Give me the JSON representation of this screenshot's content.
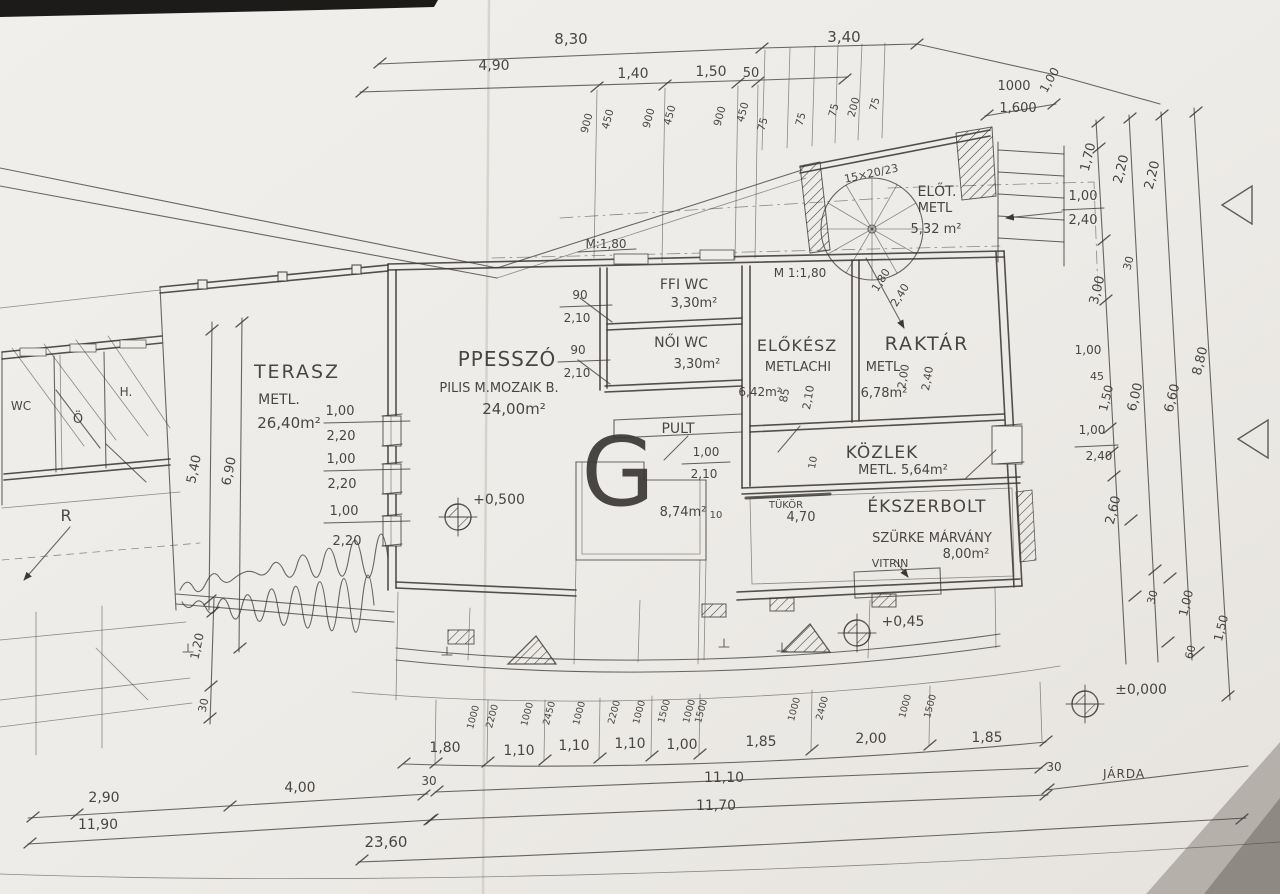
{
  "meta": {
    "kind": "scanned hand-drawn architectural floor plan"
  },
  "watermark": "G",
  "rooms": {
    "terasz": {
      "name": "TERASZ",
      "mat": "METL.",
      "area": "26,40m²"
    },
    "presszo": {
      "name": "PPESSZÓ",
      "mat": "PILIS M.MOZAIK B.",
      "area": "24,00m²"
    },
    "ffi_wc": {
      "name": "FFI WC",
      "area": "3,30m²"
    },
    "noi_wc": {
      "name": "NŐI WC",
      "area": "3,30m²"
    },
    "elokesz": {
      "name": "ELŐKÉSZ",
      "mat": "METLACHI",
      "area": "6,42m²"
    },
    "raktar": {
      "name": "RAKTÁR",
      "mat": "METL",
      "area": "6,78m²"
    },
    "elot": {
      "name": "ELŐT.",
      "mat": "METL",
      "area": "5,32 m²"
    },
    "kozlek": {
      "name": "KÖZLEK",
      "mat": "METL. 5,64m²"
    },
    "ekszerbolt": {
      "name": "ÉKSZERBOLT",
      "mat": "SZÜRKE MÁRVÁNY",
      "area": "8,00m²"
    },
    "pult": "PULT",
    "eloter_area": "8,74m²",
    "tukor": "TÜKÖR",
    "vitrin": "VITRIN",
    "wc": "WC",
    "o": "Ö",
    "h": "H.",
    "r": "R"
  },
  "notes": {
    "stair": "15×20/23",
    "scale1": "M:1,80",
    "scale2": "M 1:1,80",
    "jarda": "JÁRDA"
  },
  "levels": {
    "terasz": "+0,500",
    "entrance": "+0,45",
    "street": "±0,000"
  },
  "dims": {
    "top1": [
      "8,30",
      "3,40"
    ],
    "top2": [
      "4,90",
      "1,40",
      "1,50",
      "50"
    ],
    "topv": [
      "900",
      "450",
      "900",
      "450",
      "900",
      "450",
      "75",
      "75",
      "75",
      "200",
      "75"
    ],
    "topr": [
      "1000",
      "1,600",
      "1,00"
    ],
    "right": [
      "1,70",
      "2,20",
      "2,20",
      "1,00",
      "2,40",
      "30",
      "3,00",
      "1,00",
      "45",
      "1,50",
      "6,00",
      "6,60",
      "8,80",
      "1,00",
      "2,40",
      "2,60",
      "30",
      "1,00",
      "1,50",
      "60"
    ],
    "left": [
      "5,40",
      "6,90",
      "1,20",
      "30"
    ],
    "west": [
      "1,00",
      "2,20",
      "1,00",
      "2,20",
      "1,00",
      "2,20"
    ],
    "doors": [
      "90",
      "2,10",
      "90",
      "2,10",
      "85",
      "2,10",
      "1,00",
      "2,10",
      "1,80",
      "2,40",
      "2,00",
      "2,40"
    ],
    "inner": [
      "4,70",
      "10",
      "10"
    ],
    "botsmall": [
      "1000",
      "2200",
      "1000",
      "2450",
      "1000",
      "2200",
      "1000",
      "1500",
      "1000",
      "1500",
      "1000",
      "2400",
      "1000",
      "1500"
    ],
    "bot1": [
      "1,80",
      "1,10",
      "1,10",
      "1,10",
      "1,00",
      "1,85",
      "2,00",
      "1,85"
    ],
    "bot2": [
      "30",
      "11,10",
      "30"
    ],
    "bot3": "11,70",
    "bot4": "23,60",
    "botleft": [
      "2,90",
      "4,00",
      "11,90"
    ]
  }
}
